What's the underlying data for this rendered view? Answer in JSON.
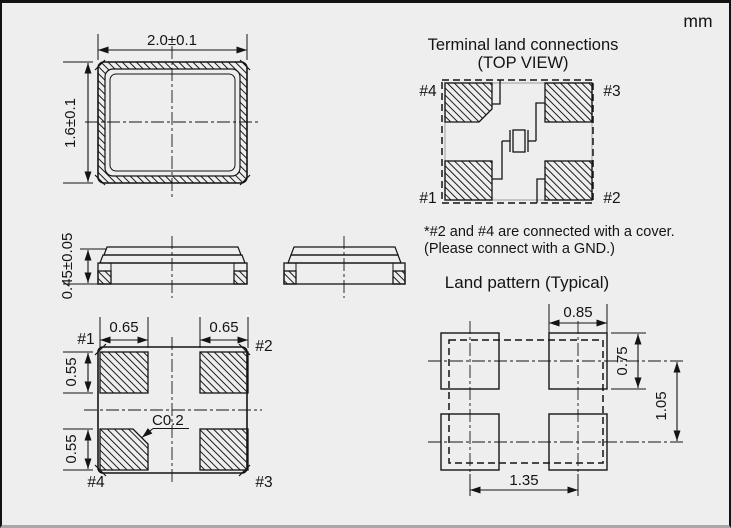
{
  "unit_label": "mm",
  "colors": {
    "line": "#141414",
    "background": "#eeeeee"
  },
  "top_view": {
    "width_dim": "2.0±0.1",
    "height_dim": "1.6±0.1"
  },
  "side_views": {
    "thickness_dim": "0.45±0.05"
  },
  "bottom_view": {
    "pad_width_left_dim": "0.65",
    "pad_width_right_dim": "0.65",
    "pad_height_top_dim": "0.55",
    "pad_height_bottom_dim": "0.55",
    "chamfer_dim": "C0.2",
    "pins": {
      "p1": "#1",
      "p2": "#2",
      "p3": "#3",
      "p4": "#4"
    }
  },
  "terminal_land_connections": {
    "title": "Terminal land connections",
    "subtitle": "(TOP VIEW)",
    "pins": {
      "p1": "#1",
      "p2": "#2",
      "p3": "#3",
      "p4": "#4"
    },
    "note_line1": "*#2 and #4 are connected with a cover.",
    "note_line2": "(Please connect with a GND.)"
  },
  "land_pattern": {
    "title": "Land pattern (Typical)",
    "pad_width_dim": "0.85",
    "pad_height_dim": "0.75",
    "row_pitch_dim": "1.05",
    "column_pitch_dim": "1.35"
  }
}
